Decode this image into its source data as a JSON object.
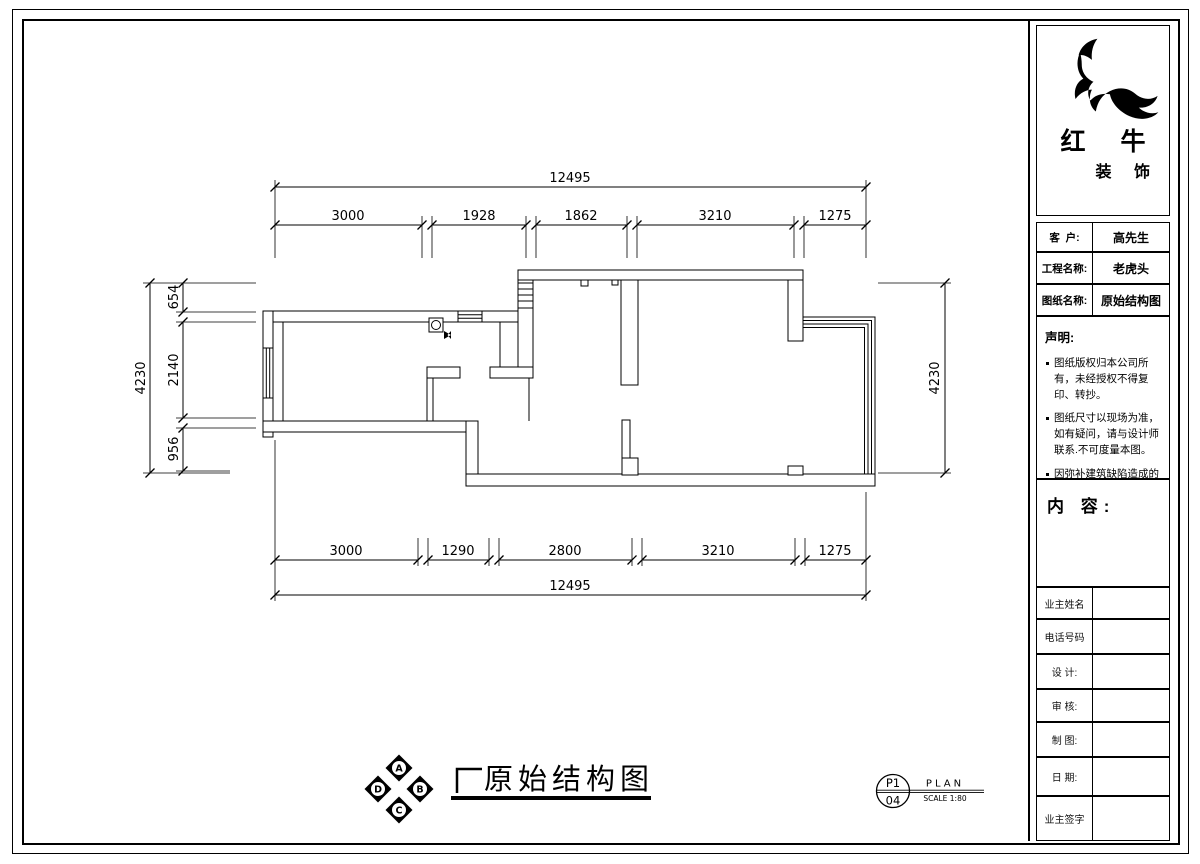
{
  "title_block": {
    "logo": {
      "icon": "bull-swoosh-logo",
      "brand": "红 牛",
      "brand_sub": "装 饰"
    },
    "info_fields": [
      {
        "label": "客  户:",
        "value": "高先生"
      },
      {
        "label": "工程名称:",
        "value": "老虎头"
      },
      {
        "label": "图纸名称:",
        "value": "原始结构图"
      }
    ],
    "statement": {
      "title": "声明:",
      "items": [
        "图纸版权归本公司所有，未经授权不得复印、转抄。",
        "图纸尺寸以现场为准，如有疑问，请与设计师联系.不可度量本图。",
        "因弥补建筑缺陷造成的费用增加与设计无关."
      ]
    },
    "content_label": "内 容:",
    "sign_rows": [
      "业主姓名",
      "电话号码",
      "设 计:",
      "审 核:",
      "制 图:",
      "日 期:",
      "业主签字"
    ]
  },
  "drawing": {
    "plan_title": "原始结构图",
    "compass_letters": [
      "A",
      "B",
      "C",
      "D"
    ],
    "sheet_ref": {
      "code": "P1",
      "number": "04",
      "view": "PLAN",
      "scale": "SCALE 1:80"
    },
    "dimensions": {
      "top": {
        "total": "12495",
        "segments": [
          "3000",
          "1928",
          "1862",
          "3210",
          "1275"
        ]
      },
      "bottom": {
        "total": "12495",
        "segments": [
          "3000",
          "1290",
          "2800",
          "3210",
          "1275"
        ]
      },
      "left": {
        "total": "4230",
        "segments": [
          "654",
          "2140",
          "956"
        ]
      },
      "right": {
        "total": "4230"
      }
    }
  },
  "colors": {
    "line": "#000000",
    "paper": "#ffffff"
  }
}
